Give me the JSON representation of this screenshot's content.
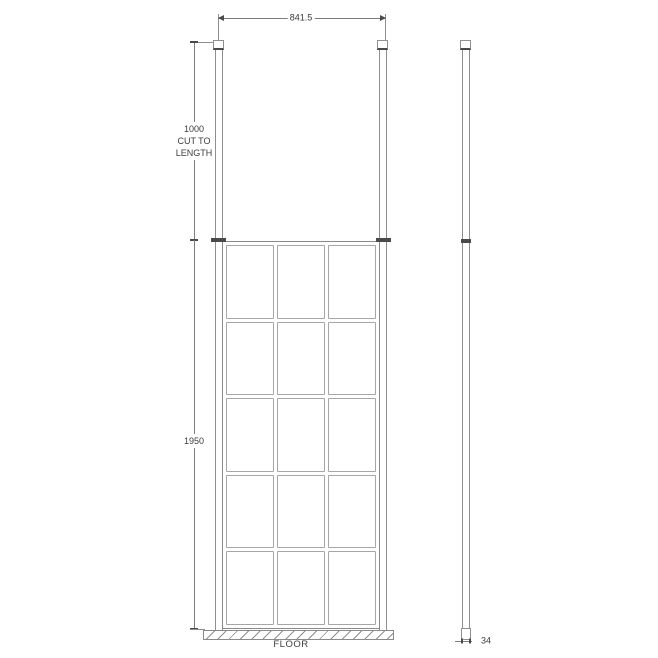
{
  "drawing_type": "shower-screen-technical-drawing",
  "dimensions": {
    "width": {
      "label": "841.5"
    },
    "drop": {
      "lines": [
        "1000",
        "CUT TO",
        "LENGTH"
      ]
    },
    "height": {
      "label": "1950"
    },
    "depth": {
      "label": "34"
    }
  },
  "floor": {
    "label": "FLOOR"
  },
  "panel_grid": {
    "columns": 3,
    "rows": 5
  },
  "colors": {
    "line": "#8f8f8f",
    "frame": "#8a8a8a",
    "panes": "#a6a6a6",
    "dim": "#7d7d7d",
    "dark": "#4a4a4a",
    "text": "#3c3c3c"
  }
}
